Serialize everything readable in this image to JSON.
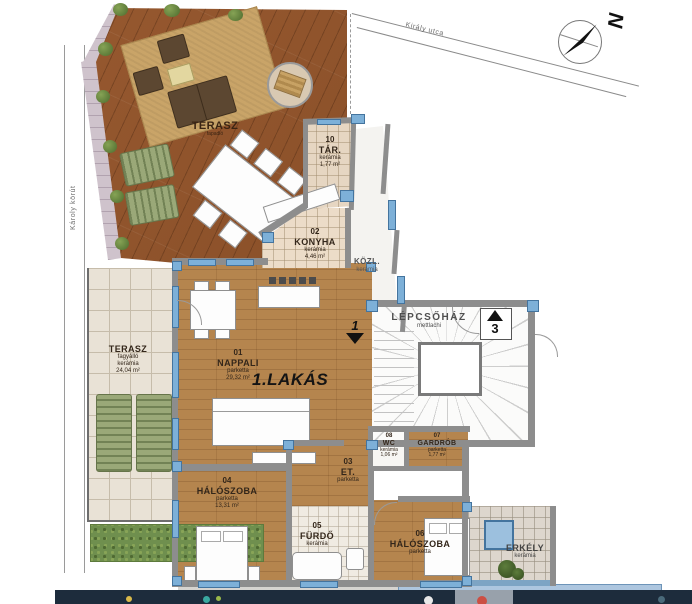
{
  "plan": {
    "apartment_title": "1.LAKÁS",
    "streets": {
      "top": "Király utca",
      "left": "Károly körút"
    },
    "compass": {
      "north_letter": "N"
    },
    "entrance_markers": {
      "apartment1": "1",
      "apartment3": "3"
    },
    "rooms": {
      "terasz_deck": {
        "name": "TERASZ",
        "finish": "fapadló"
      },
      "terasz_tile": {
        "name": "TERASZ",
        "finish": "fagyálló",
        "finish2": "kerámia",
        "area": "24,04 m²"
      },
      "tar": {
        "number": "10",
        "name": "TÁR.",
        "finish": "kerámia",
        "area": "1,77 m²"
      },
      "konyha": {
        "number": "02",
        "name": "KONYHA",
        "finish": "kerámia",
        "area": "4,46 m²"
      },
      "kozl": {
        "name": "KÖZL.",
        "finish": "kerámia"
      },
      "lepcsohaz": {
        "name": "LÉPCSŐHÁZ",
        "finish": "mettlachi"
      },
      "nappali": {
        "number": "01",
        "name": "NAPPALI",
        "finish": "parketta",
        "area": "29,32 m²"
      },
      "wc": {
        "number": "08",
        "name": "WC",
        "finish": "kerámia",
        "area": "1,06 m²"
      },
      "gardrob": {
        "number": "07",
        "name": "GARDRÓB",
        "finish": "parketta",
        "area": "1,77 m²"
      },
      "et": {
        "number": "03",
        "name": "ET.",
        "finish": "parketta"
      },
      "haloszoba04": {
        "number": "04",
        "name": "HÁLÓSZOBA",
        "finish": "parketta",
        "area": "13,31 m²"
      },
      "furdo": {
        "number": "05",
        "name": "FÜRDŐ",
        "finish": "kerámia"
      },
      "haloszoba06": {
        "number": "06",
        "name": "HÁLÓSZOBA",
        "finish": "parketta"
      },
      "erkely": {
        "name": "ERKÉLY",
        "finish": "kerámia"
      }
    }
  },
  "colors": {
    "deck_wood": "#96582f",
    "parquet": "#b5854e",
    "tile": "#e9e2d6",
    "tile_line": "#c6bcaa",
    "wall": "#8d8d8d",
    "window_blue": "#7db0d8",
    "window_border": "#44749e",
    "hedge": "#6f8f4e",
    "taskbar_bg": "#1d2c3c"
  },
  "taskbar": {
    "icons": [
      {
        "name": "taskbar-icon-yellow",
        "color": "#d9b94a",
        "x": 71,
        "size": 6
      },
      {
        "name": "taskbar-icon-teal",
        "color": "#3aa9a0",
        "x": 148,
        "size": 7
      },
      {
        "name": "taskbar-icon-green",
        "color": "#9ab94a",
        "x": 161,
        "size": 5
      },
      {
        "name": "taskbar-icon-white",
        "color": "#e8e8e8",
        "x": 369,
        "size": 9
      },
      {
        "name": "taskbar-icon-red",
        "color": "#cc4f43",
        "x": 422,
        "size": 10
      },
      {
        "name": "taskbar-icon-dim",
        "color": "#4a6a7a",
        "x": 603,
        "size": 7
      }
    ]
  }
}
